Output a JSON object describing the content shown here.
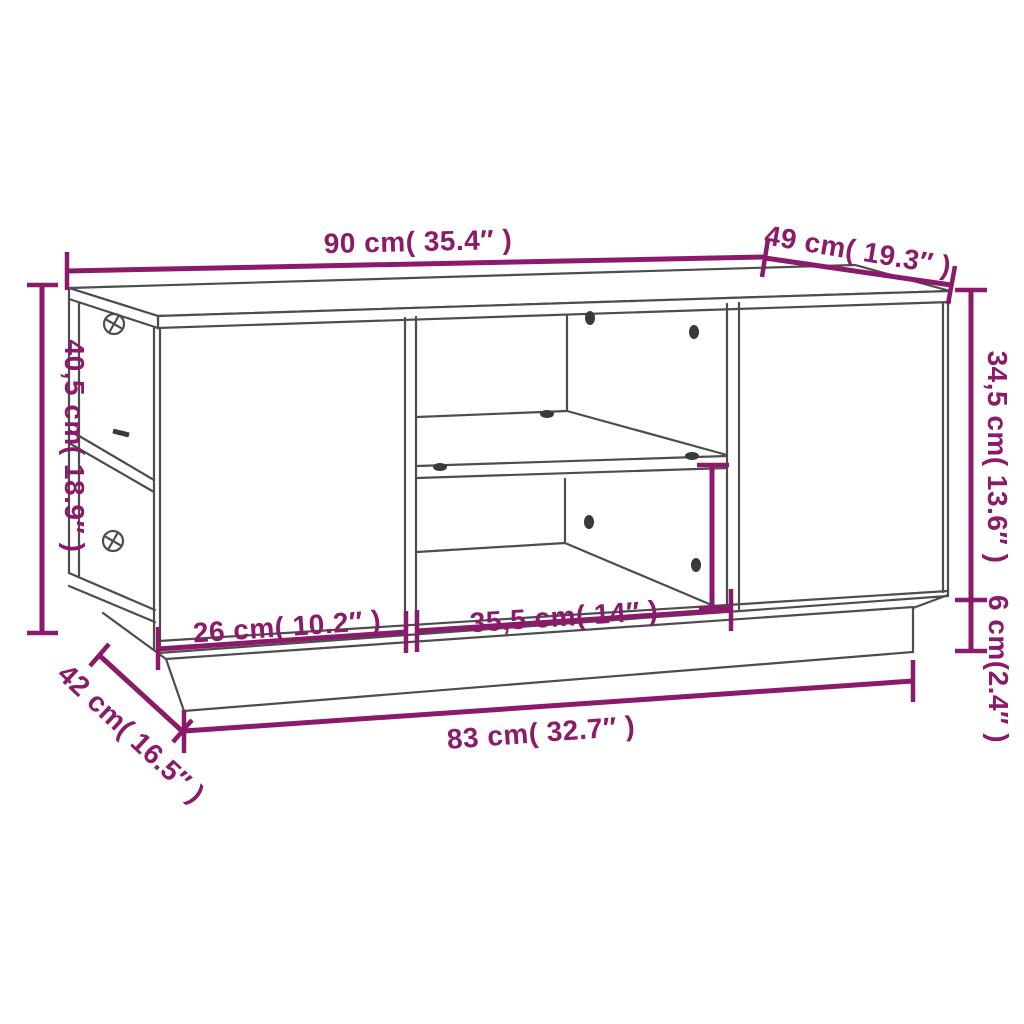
{
  "diagram": {
    "type": "furniture-dimension-line-drawing",
    "colors": {
      "dimension_accent": "#8B1A6A",
      "drawing_line": "#4d4d4d",
      "background": "#ffffff"
    },
    "dimensions": {
      "top_width": "90 cm( 35.4″  )",
      "top_depth": "49 cm( 19.3″  )",
      "total_height": "40,5 cm( 18.9″  )",
      "body_height": "34,5 cm( 13.6″  )",
      "base_height": "6 cm(2.4″  )",
      "left_door_width": "26 cm( 10.2″  )",
      "middle_opening_width": "35,5 cm( 14″  )",
      "base_width": "83 cm( 32.7″  )",
      "base_depth": "42 cm( 16.5″  )"
    }
  }
}
